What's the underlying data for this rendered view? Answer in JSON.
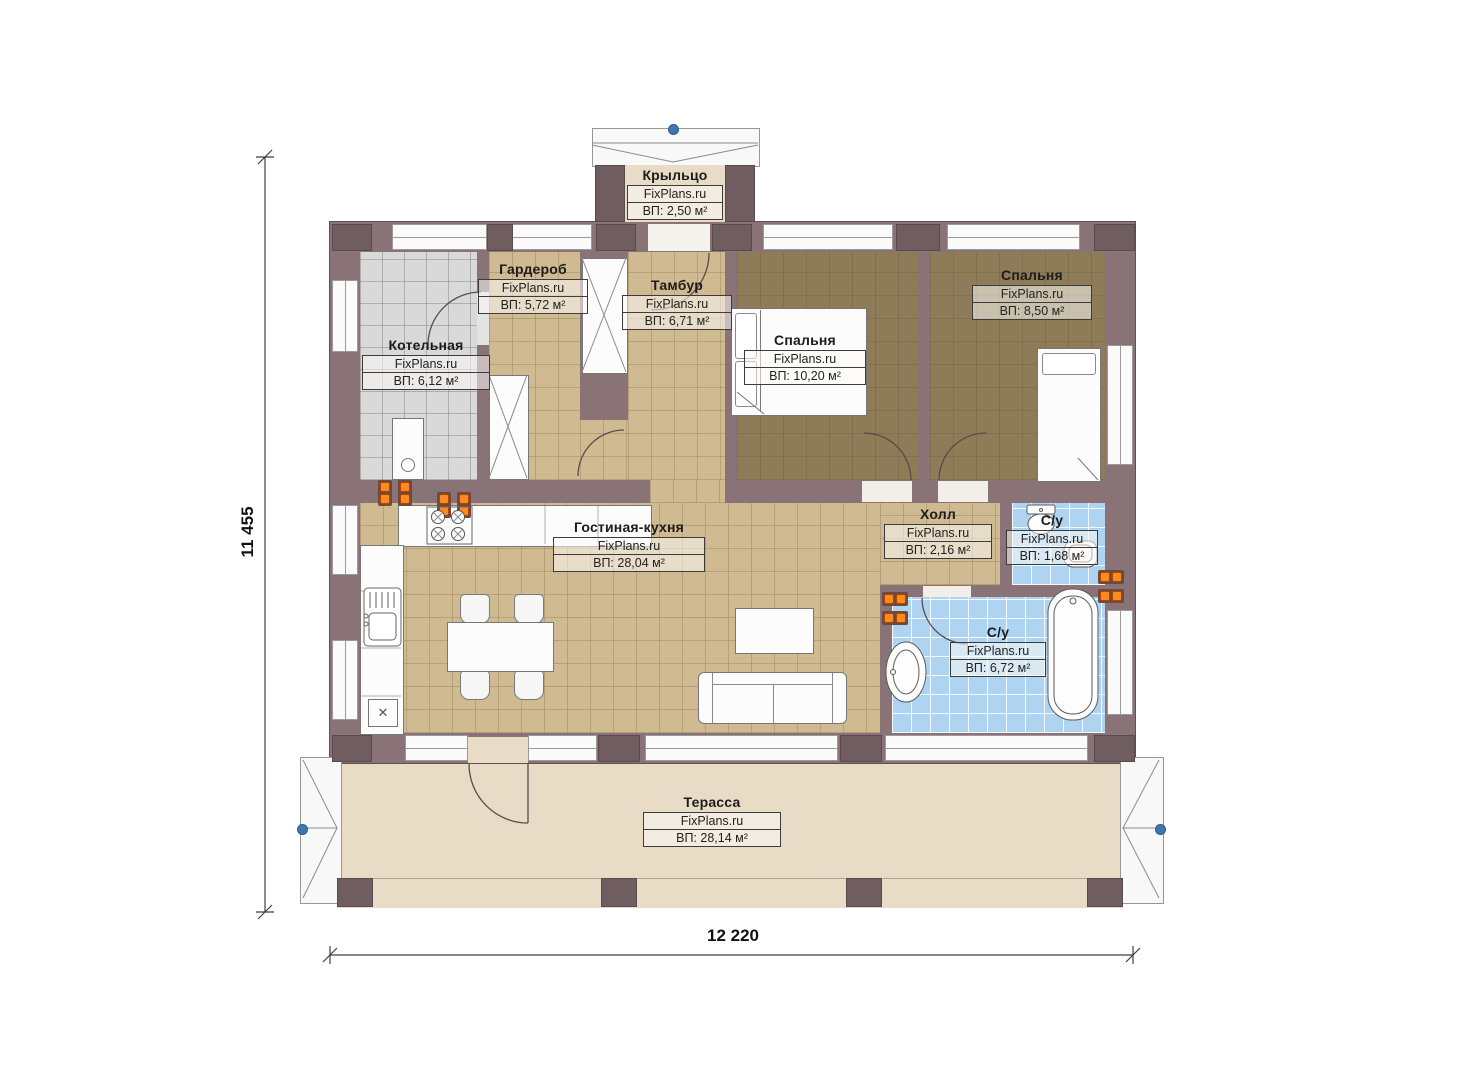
{
  "brand": "FixPlans.ru",
  "dimensions": {
    "height": "11 455",
    "width": "12 220"
  },
  "rooms": {
    "porch": {
      "name": "Крыльцо",
      "brand": "FixPlans.ru",
      "area": "ВП: 2,50 м²"
    },
    "boiler": {
      "name": "Котельная",
      "brand": "FixPlans.ru",
      "area": "ВП: 6,12 м²"
    },
    "wardrobe": {
      "name": "Гардероб",
      "brand": "FixPlans.ru",
      "area": "ВП: 5,72 м²"
    },
    "vestibule": {
      "name": "Тамбур",
      "brand": "FixPlans.ru",
      "area": "ВП: 6,71 м²"
    },
    "bedroom1": {
      "name": "Спальня",
      "brand": "FixPlans.ru",
      "area": "ВП: 10,20 м²"
    },
    "bedroom2": {
      "name": "Спальня",
      "brand": "FixPlans.ru",
      "area": "ВП: 8,50 м²"
    },
    "living": {
      "name": "Гостиная-кухня",
      "brand": "FixPlans.ru",
      "area": "ВП: 28,04 м²"
    },
    "hall": {
      "name": "Холл",
      "brand": "FixPlans.ru",
      "area": "ВП: 2,16 м²"
    },
    "bathroom_small": {
      "name": "С/у",
      "brand": "FixPlans.ru",
      "area": "ВП: 1,68 м²"
    },
    "bathroom_main": {
      "name": "С/у",
      "brand": "FixPlans.ru",
      "area": "ВП: 6,72 м²"
    },
    "terrace": {
      "name": "Терасса",
      "brand": "FixPlans.ru",
      "area": "ВП: 28,14 м²"
    }
  },
  "colors": {
    "wall": "#8a7376",
    "wall_post": "#6f5d60",
    "floor_tan": "#cfba92",
    "floor_gray": "#d9d9d9",
    "floor_bedroom": "#8d7c57",
    "floor_blue": "#aed4f2",
    "terrace_beige": "#e8dcc6",
    "radiator_orange": "#ff8a1e",
    "marker_blue": "#3f76ad"
  }
}
